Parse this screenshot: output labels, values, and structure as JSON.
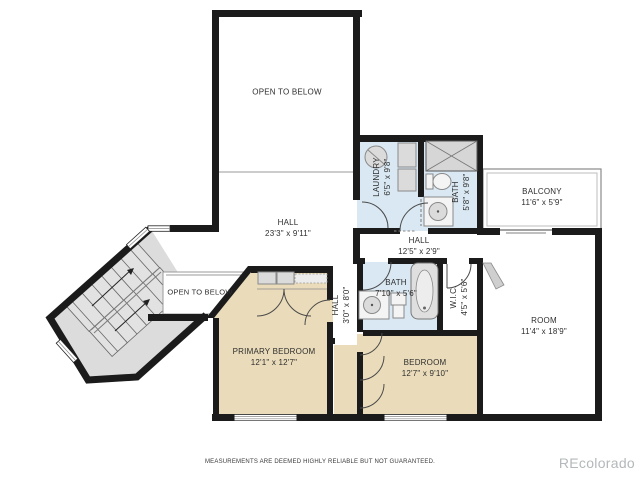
{
  "colors": {
    "wall": "#1b1b1b",
    "bedroom_fill": "#EADCBA",
    "bath_fill": "#D9E8F2",
    "stair_fill": "#DCDCDC",
    "fixture_fill": "#DBDBDB",
    "fixture_stroke": "#8A8A8A",
    "thin_line": "#9A9A9A",
    "label_text": "#2E2E2E",
    "watermark": "#B4B8BA"
  },
  "rooms": {
    "open_to_below_top": {
      "name": "OPEN TO BELOW"
    },
    "hall_main": {
      "name": "HALL",
      "dims": "23'3\" x 9'11\""
    },
    "laundry": {
      "name": "LAUNDRY",
      "dims": "6'5\" x 9'8\""
    },
    "bath_upper": {
      "name": "BATH",
      "dims": "5'8\" x 9'8\""
    },
    "balcony": {
      "name": "BALCONY",
      "dims": "11'6\" x 5'9\""
    },
    "hall_upper": {
      "name": "HALL",
      "dims": "12'5\" x 2'9\""
    },
    "open_to_below_stairs": {
      "name": "OPEN TO BELOW"
    },
    "primary_bedroom": {
      "name": "PRIMARY BEDROOM",
      "dims": "12'1\" x 12'7\""
    },
    "hall_vertical": {
      "name": "HALL",
      "dims": "3'0\" x 8'0\""
    },
    "bath_lower": {
      "name": "BATH",
      "dims": "7'10\" x 5'6\""
    },
    "wic": {
      "name": "W.I.C.",
      "dims": "4'5\" x 5'6\""
    },
    "bedroom": {
      "name": "BEDROOM",
      "dims": "12'7\" x 9'10\""
    },
    "room": {
      "name": "ROOM",
      "dims": "11'4\" x 18'9\""
    }
  },
  "footer": {
    "disclaimer": "MEASUREMENTS ARE DEEMED HIGHLY RELIABLE BUT NOT GUARANTEED.",
    "watermark": "REcolorado"
  }
}
